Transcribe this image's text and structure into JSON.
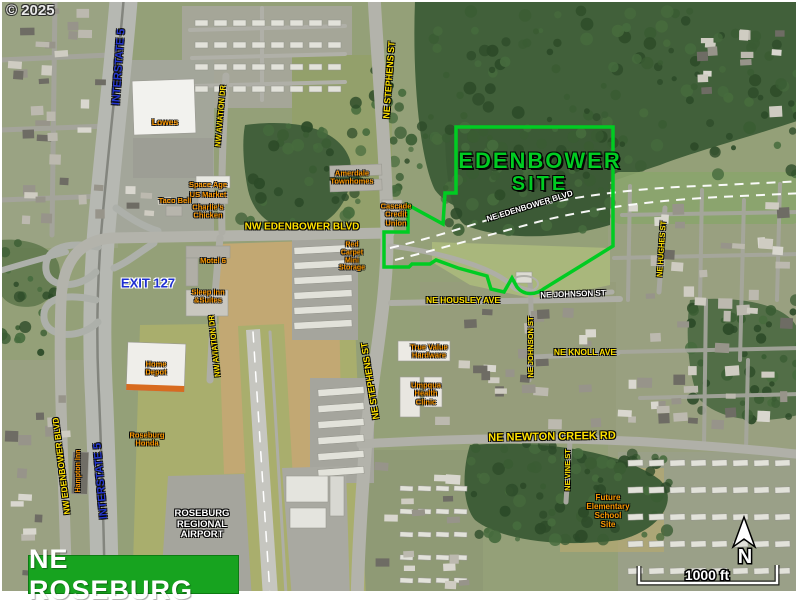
{
  "copyright": "© 2025",
  "banner": {
    "text": "NE ROSEBURG"
  },
  "site": {
    "name_line1": "EDENBOWER",
    "name_line2": "SITE"
  },
  "scale_bar": {
    "label": "1000 ft"
  },
  "north_arrow": {
    "label": "N"
  },
  "colors": {
    "road_label": "#FFE100",
    "business_label": "#FF9900",
    "highway_label": "#2537CE",
    "white_label": "#FFFFFF",
    "site_green": "#00CC22",
    "banner_green": "#17A31F"
  },
  "labels": [
    {
      "name": "road-label-ne-stephens-st-north",
      "type": "road",
      "text": "NE STEPHENS ST",
      "x": 389,
      "y": 80,
      "rot": -86,
      "size": 9
    },
    {
      "name": "road-label-ne-stephens-st-south",
      "type": "road",
      "text": "NE STEPHENS ST",
      "x": 370,
      "y": 381,
      "rot": -99,
      "size": 9
    },
    {
      "name": "road-label-nw-aviation-dr-north",
      "type": "road",
      "text": "NW AVIATION DR",
      "x": 221,
      "y": 116,
      "rot": -85,
      "size": 7.5
    },
    {
      "name": "road-label-nw-aviation-dr-south",
      "type": "road",
      "text": "NW AVIATION DR",
      "x": 215,
      "y": 346,
      "rot": -96,
      "size": 7.5
    },
    {
      "name": "road-label-nw-edenbower-blvd",
      "type": "road",
      "text": "NW EDENBOWER BLVD",
      "x": 302,
      "y": 227,
      "rot": 0,
      "size": 10
    },
    {
      "name": "road-label-nw-edenbower-blvd-west",
      "type": "road",
      "text": "NW EDENBOWER BLVD",
      "x": 62,
      "y": 466,
      "rot": -97,
      "size": 8.5
    },
    {
      "name": "road-label-ne-housley-ave",
      "type": "road",
      "text": "NE HOUSLEY AVE",
      "x": 463,
      "y": 301,
      "rot": 0,
      "size": 8.5
    },
    {
      "name": "road-label-ne-johnson-st-vertical",
      "type": "road",
      "text": "NE JOHNSON ST",
      "x": 531,
      "y": 347,
      "rot": -90,
      "size": 7.5
    },
    {
      "name": "road-label-ne-knoll-ave",
      "type": "road",
      "text": "NE KNOLL AVE",
      "x": 585,
      "y": 353,
      "rot": 0,
      "size": 8.5
    },
    {
      "name": "road-label-ne-newton-creek-rd",
      "type": "road",
      "text": "NE NEWTON CREEK RD",
      "x": 552,
      "y": 437,
      "rot": -1,
      "size": 11
    },
    {
      "name": "road-label-ne-vine-st",
      "type": "road",
      "text": "NE VINE ST",
      "x": 568,
      "y": 470,
      "rot": -90,
      "size": 7.5
    },
    {
      "name": "road-label-ne-hughes-st",
      "type": "road",
      "text": "NE HUGHES ST",
      "x": 662,
      "y": 249,
      "rot": -86,
      "size": 7.5
    },
    {
      "name": "highway-label-interstate-5-north",
      "type": "highway",
      "text": "INTERSTATE 5",
      "x": 119,
      "y": 67,
      "rot": -86,
      "size": 11
    },
    {
      "name": "highway-label-interstate-5-south",
      "type": "highway",
      "text": "INTERSTATE 5",
      "x": 101,
      "y": 481,
      "rot": -95,
      "size": 11
    },
    {
      "name": "highway-label-exit-127",
      "type": "exit",
      "text": "EXIT 127",
      "x": 148,
      "y": 284,
      "rot": 0,
      "size": 13
    },
    {
      "name": "road-label-ne-edenbower-blvd-proposed",
      "type": "white",
      "text": "NE EDENBOWER BLVD",
      "x": 530,
      "y": 207,
      "rot": -17,
      "size": 8
    },
    {
      "name": "road-label-ne-johnson-st",
      "type": "white",
      "text": "NE JOHNSON ST",
      "x": 573,
      "y": 295,
      "rot": -2,
      "size": 8
    },
    {
      "name": "area-label-roseburg-regional-airport",
      "type": "white",
      "lines": [
        "ROSEBURG",
        "REGIONAL",
        "AIRPORT"
      ],
      "x": 202,
      "y": 525,
      "rot": 0,
      "size": 9.5
    },
    {
      "name": "business-label-lowes",
      "type": "business",
      "text": "Lowes",
      "x": 165,
      "y": 123,
      "rot": 0,
      "size": 8.5
    },
    {
      "name": "business-label-space-age",
      "type": "business",
      "text": "Space Age",
      "x": 208,
      "y": 185,
      "rot": 0,
      "size": 7.5
    },
    {
      "name": "business-label-us-market",
      "type": "business",
      "text": "US Market",
      "x": 208,
      "y": 195,
      "rot": 0,
      "size": 7.5
    },
    {
      "name": "business-label-charlies-chicken",
      "type": "business",
      "lines": [
        "Charlie's",
        "Chicken"
      ],
      "x": 208,
      "y": 212,
      "rot": 0,
      "size": 7.5
    },
    {
      "name": "business-label-taco-bell",
      "type": "business",
      "text": "Taco Bell",
      "x": 175,
      "y": 201,
      "rot": 0,
      "size": 7.5
    },
    {
      "name": "business-label-motel-6",
      "type": "business",
      "text": "Motel 6",
      "x": 213,
      "y": 261,
      "rot": 0,
      "size": 7.5
    },
    {
      "name": "business-label-sleep-inn",
      "type": "business",
      "lines": [
        "Sleep Inn",
        "&Suites"
      ],
      "x": 208,
      "y": 297,
      "rot": 0,
      "size": 7.5
    },
    {
      "name": "business-label-home-depot",
      "type": "business",
      "lines": [
        "Home",
        "Depot"
      ],
      "x": 156,
      "y": 369,
      "rot": 0,
      "size": 7.5
    },
    {
      "name": "business-label-amerdale-townhomes",
      "type": "business",
      "lines": [
        "Amerdale",
        "Townhomes"
      ],
      "x": 352,
      "y": 178,
      "rot": 0,
      "size": 7.5
    },
    {
      "name": "business-label-cascade-credit-union",
      "type": "business",
      "lines": [
        "Cascade",
        "Credit",
        "Union"
      ],
      "x": 396,
      "y": 215,
      "rot": 0,
      "size": 7.5
    },
    {
      "name": "business-label-mini-storage",
      "type": "business",
      "lines": [
        "Red",
        "Carpet",
        "Mini",
        "Storage"
      ],
      "x": 352,
      "y": 257,
      "rot": 0,
      "size": 7
    },
    {
      "name": "business-label-true-value-hardware",
      "type": "business",
      "lines": [
        "True Value",
        "Hardware"
      ],
      "x": 429,
      "y": 352,
      "rot": 0,
      "size": 7.5
    },
    {
      "name": "business-label-umpqua-health-clinic",
      "type": "business",
      "lines": [
        "Umpqua",
        "Health",
        "Clinic"
      ],
      "x": 426,
      "y": 394,
      "rot": 0,
      "size": 7.5
    },
    {
      "name": "business-label-future-elementary-school-site",
      "type": "business",
      "lines": [
        "Future",
        "Elementary",
        "School",
        "Site"
      ],
      "x": 608,
      "y": 512,
      "rot": 0,
      "size": 8
    },
    {
      "name": "business-label-roseburg-honda",
      "type": "business",
      "lines": [
        "Roseburg",
        "Honda"
      ],
      "x": 147,
      "y": 440,
      "rot": 0,
      "size": 7.5
    },
    {
      "name": "business-label-hampton-inn",
      "type": "business",
      "text": "Hampton Inn",
      "x": 79,
      "y": 471,
      "rot": -90,
      "size": 7
    }
  ]
}
